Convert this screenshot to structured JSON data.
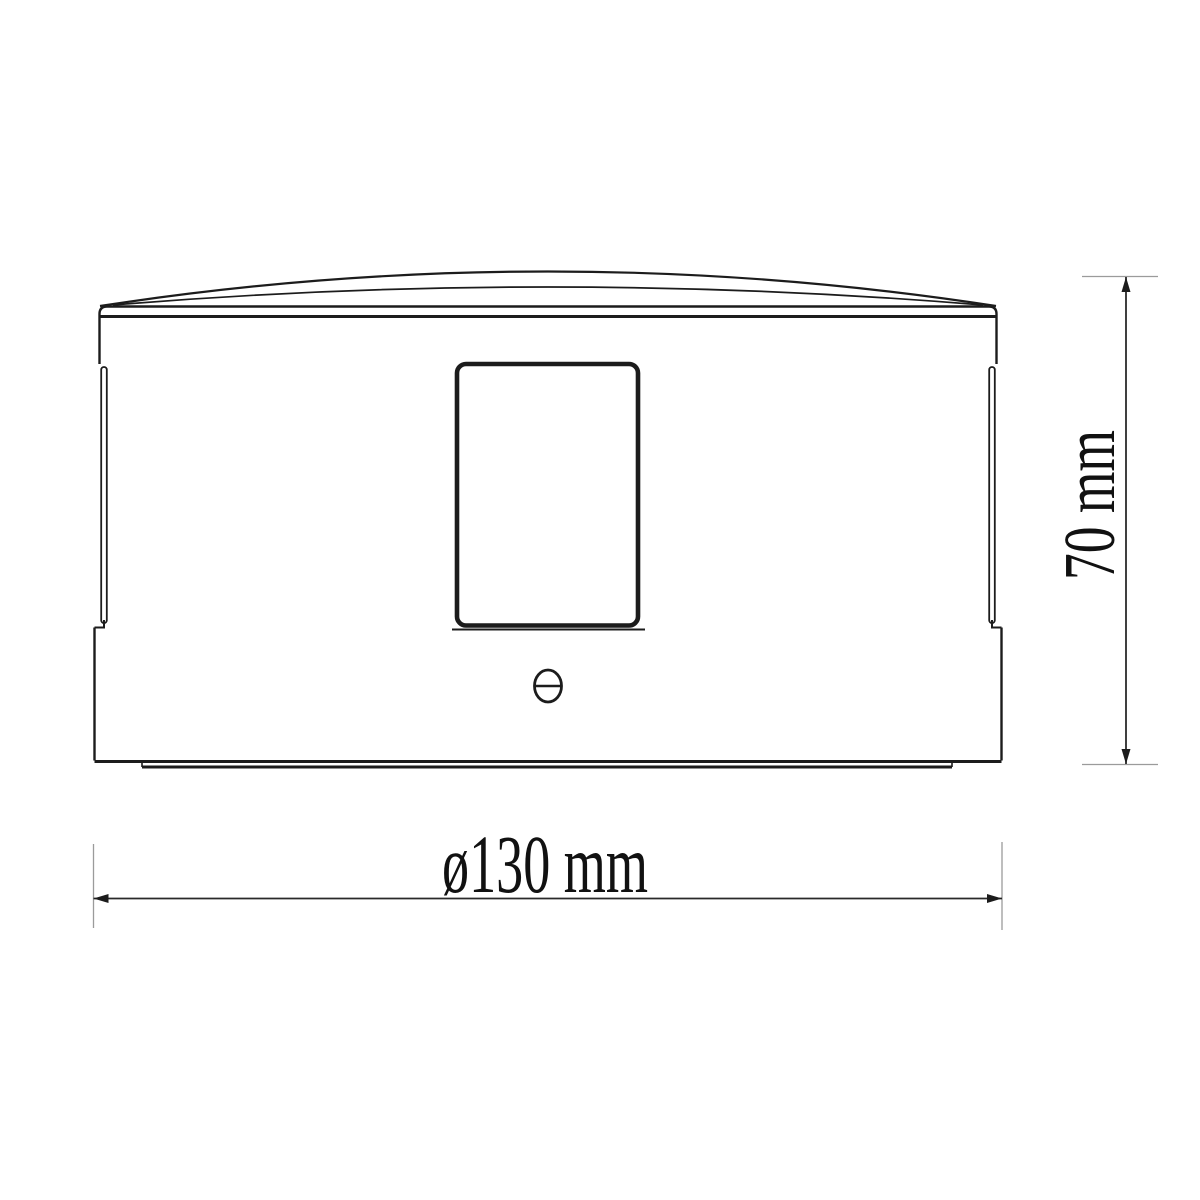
{
  "diagram": {
    "labels": {
      "width_dimension": "ø130 mm",
      "height_dimension": "70 mm"
    },
    "measurements": {
      "diameter_mm": 130,
      "height_mm": 70
    },
    "colors": {
      "line": "#1c1c1c",
      "extension_line": "#9b9b9b",
      "text": "#111111",
      "background": "#ffffff"
    }
  }
}
